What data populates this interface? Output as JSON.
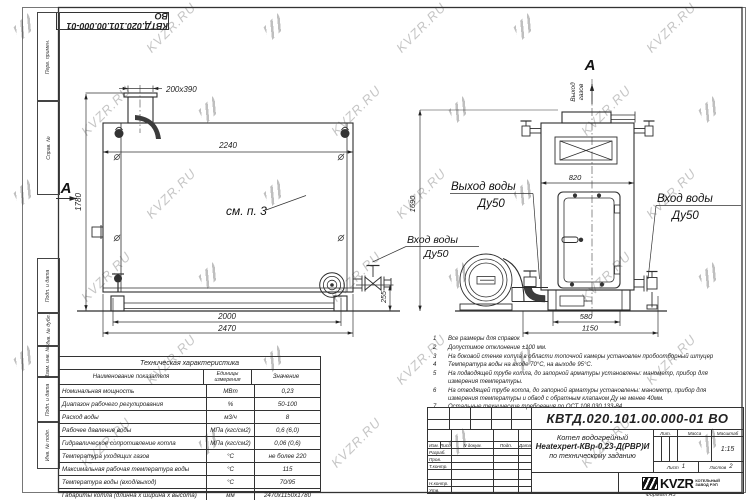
{
  "watermark": {
    "text": "KVZR.RU"
  },
  "corner_stamp": {
    "doc_number": "КВТД.020.101.00.000-01 ВО"
  },
  "side_column": {
    "labels": [
      "Перв. примен.",
      "Справ. №",
      "Подп. и дата",
      "Инв. № дубл.",
      "Взам. инв. №",
      "Подп. и дата",
      "Инв. № подл."
    ]
  },
  "left_view": {
    "section_label": "А",
    "callout": "см. п. 3",
    "dims": {
      "chimney": "200х390",
      "inner_width": "2240",
      "height": "1780",
      "base": "2000",
      "overall": "2470",
      "right": "255"
    }
  },
  "right_view": {
    "section_label": "А",
    "gas_outlet": {
      "line1": "Выход",
      "line2": "газов"
    },
    "dims": {
      "top_width": "820",
      "height": "1690",
      "base": "580",
      "overall": "1150"
    },
    "labels": {
      "outlet": {
        "line1": "Выход воды",
        "line2": "Ду50"
      },
      "inlet_right": {
        "line1": "Вход воды",
        "line2": "Ду50"
      },
      "inlet_left": {
        "line1": "Вход воды",
        "line2": "Ду50"
      }
    }
  },
  "notes": {
    "items": [
      {
        "num": "1",
        "text": "Все размеры для справок"
      },
      {
        "num": "2",
        "text": "Допустимое отклонение ±100 мм."
      },
      {
        "num": "3",
        "text": "На боковой стенке котла в области топочной камеры установлен пробоотборный штуцер"
      },
      {
        "num": "4",
        "text": "Температура воды на входе 70°С, на выходе 95°С."
      },
      {
        "num": "5",
        "text": "На подводящей трубе котла, до запорной арматуры установлены: манометр, прибор для измерения температуры."
      },
      {
        "num": "6",
        "text": "На отводящей трубе котла, до запорной арматуры установлены: манометр, прибор для измерения температуры и обвод с обратным клапаном Ду не менее 40мм."
      },
      {
        "num": "7",
        "text": "Остальные технические требования по ОСТ 108.030.133-84."
      }
    ]
  },
  "tech_table": {
    "title": "Техническая характеристика",
    "headers": [
      "Наименование показателя",
      "Единицы измерения",
      "Значение"
    ],
    "rows": [
      [
        "Номинальная мощность",
        "МВт",
        "0,23"
      ],
      [
        "Диапазон рабочего регулирования",
        "%",
        "50-100"
      ],
      [
        "Расход воды",
        "м3/ч",
        "8"
      ],
      [
        "Рабочее давление воды",
        "МПа (кгс/см2)",
        "0,6 (6,0)"
      ],
      [
        "Гидравлическое сопротивление котла",
        "МПа (кгс/см2)",
        "0,06 (0,6)"
      ],
      [
        "Температура уходящих газов",
        "°С",
        "не более 220"
      ],
      [
        "Максимальная рабочая температура воды",
        "°С",
        "115"
      ],
      [
        "Температура воды (вход/выход)",
        "°С",
        "70/95"
      ],
      [
        "Габариты котла (длинна х ширина х высота)",
        "мм",
        "2470х1150х1780"
      ]
    ]
  },
  "title_block": {
    "doc_number": "КВТД.020.101.00.000-01 ВО",
    "sig_cols": [
      "Изм.",
      "Лист",
      "N докум.",
      "Подп.",
      "Дата"
    ],
    "sig_rows": [
      "Разраб.",
      "Пров.",
      "Т.контр.",
      "Н.контр.",
      "Утв."
    ],
    "product": {
      "line1": "Котел водогрейный",
      "line2": "Heatexpert-КВр-0,23-Д(РВР)И",
      "line3": "по техническому заданию"
    },
    "lit_label": "Лит.",
    "mass_label": "Масса",
    "scale_label": "Масштаб",
    "scale_value": "1:15",
    "sheet_label": "Лист",
    "sheet_value": "1",
    "sheets_label": "Листов",
    "sheets_value": "2",
    "company": {
      "logo": "KVZR",
      "line1": "КОТЕЛЬНЫЙ",
      "line2": "ЗАВОД РЭП"
    },
    "format": "Формат А3"
  }
}
